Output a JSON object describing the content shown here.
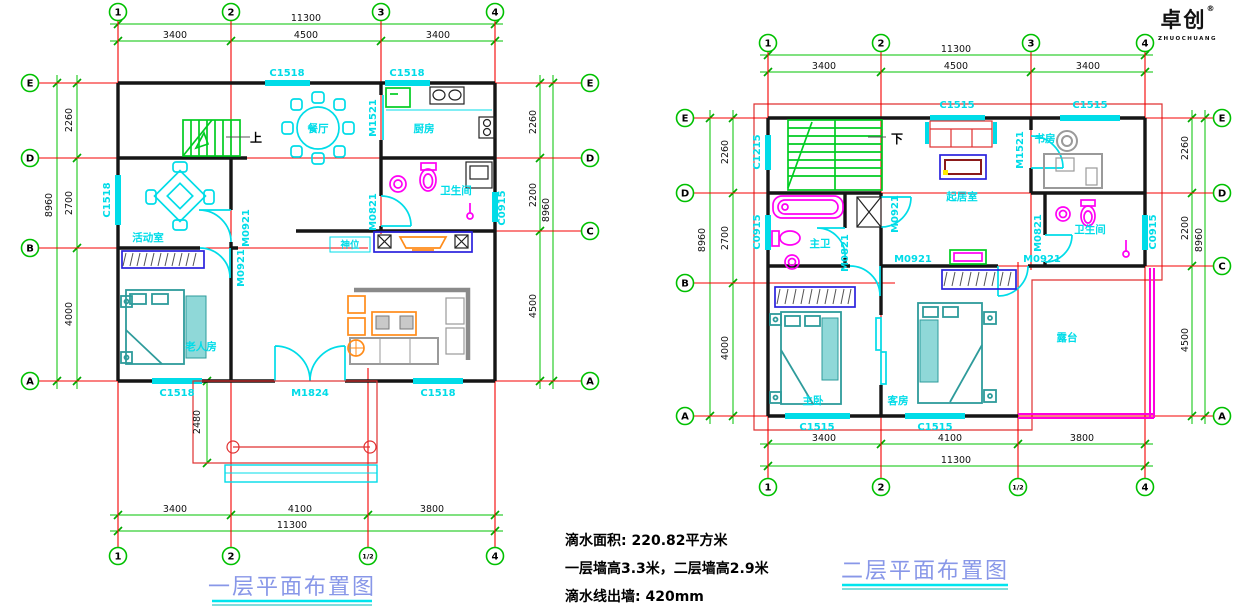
{
  "colors": {
    "axis_red": "#f40000",
    "dim_green": "#00c300",
    "cad_cyan": "#00dce8",
    "fixture_magenta": "#ff00f4",
    "furniture_teal": "#2e9b9b",
    "furniture_orange": "#ff8c1a",
    "stair_green": "#00cc22",
    "title_blue": "#8897e8"
  },
  "logo": {
    "name": "卓创",
    "reg": "®",
    "sub": "ZHUOCHUANG"
  },
  "notes": {
    "line1": "滴水面积: 220.82平方米",
    "line2": "一层墙高3.3米，二层墙高2.9米",
    "line3": "滴水线出墙: 420mm"
  },
  "plan1": {
    "title": "一层平面布置图",
    "grid": {
      "top": [
        "1",
        "2",
        "3",
        "4"
      ],
      "bottom": [
        "1",
        "2",
        "1/2",
        "4"
      ],
      "left": [
        "E",
        "D",
        "B",
        "A"
      ],
      "right": [
        "E",
        "D",
        "C",
        "A"
      ]
    },
    "dims": {
      "top_total": "11300",
      "top_segs": [
        "3400",
        "4500",
        "3400"
      ],
      "bottom_total": "11300",
      "bottom_segs": [
        "3400",
        "4100",
        "3800"
      ],
      "left_total": "8960",
      "left_segs": [
        "2260",
        "2700",
        "4000"
      ],
      "right_total": "8960",
      "right_segs": [
        "2260",
        "2200",
        "4500"
      ],
      "porch": "2480"
    },
    "labels": {
      "win_top1": "C1518",
      "win_top2": "C1518",
      "win_left": "C1518",
      "win_right": "C0915",
      "win_bottom1": "C1518",
      "door_main": "M1824",
      "win_bottom2": "C1518",
      "door_kitchen": "M1521",
      "door_bath": "M0821",
      "door_activity": "M0921",
      "door_elder": "M0921"
    },
    "rooms": {
      "dining": "餐厅",
      "kitchen": "厨房",
      "bath": "卫生间",
      "activity": "活动室",
      "elder": "老人房",
      "shrine": "神位",
      "stairs_up": "上"
    }
  },
  "plan2": {
    "title": "二层平面布置图",
    "grid": {
      "top": [
        "1",
        "2",
        "3",
        "4"
      ],
      "bottom": [
        "1",
        "2",
        "1/2",
        "4"
      ],
      "left": [
        "E",
        "D",
        "B",
        "A"
      ],
      "right": [
        "E",
        "D",
        "C",
        "A"
      ]
    },
    "dims": {
      "top_total": "11300",
      "top_segs": [
        "3400",
        "4500",
        "3400"
      ],
      "bottom_total": "11300",
      "bottom_segs": [
        "3400",
        "4100",
        "3800"
      ],
      "left_total": "8960",
      "left_segs": [
        "2260",
        "2700",
        "4000"
      ],
      "right_total": "8960",
      "right_segs": [
        "2260",
        "2200",
        "4500"
      ]
    },
    "labels": {
      "win_top1": "C1515",
      "win_top2": "C1515",
      "win_left1": "C1215",
      "win_left2": "C0915",
      "win_right": "C0915",
      "win_bottom1": "C1515",
      "win_bottom2": "C1515",
      "door_study": "M1521",
      "door_mbath": "M0821",
      "door_bath": "M0821",
      "door_hall": "M0921",
      "door_master": "M0921",
      "door_guest": "M0921"
    },
    "rooms": {
      "study": "书房",
      "living": "起居室",
      "mbath": "主卫",
      "bath": "卫生间",
      "master": "主卧",
      "guest": "客房",
      "terrace": "露台",
      "stairs_down": "下"
    }
  }
}
